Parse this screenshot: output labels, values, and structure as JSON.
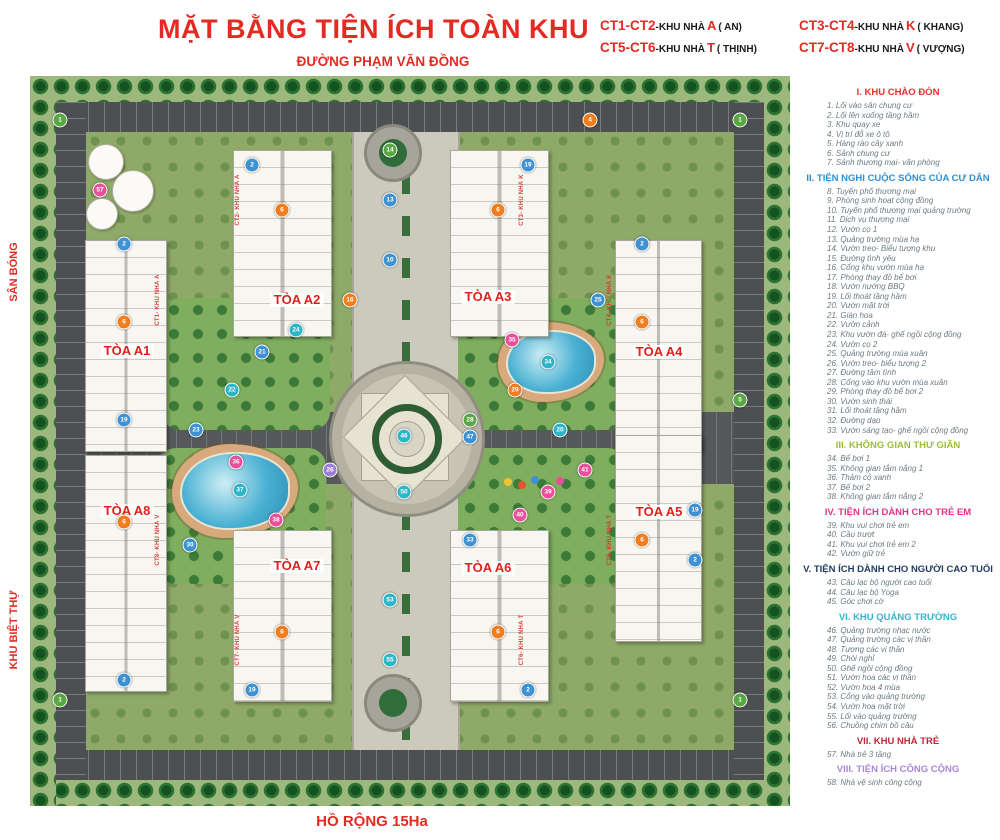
{
  "header": {
    "title": "MẶT BẰNG TIỆN ÍCH TOÀN KHU",
    "building_key": [
      {
        "code": "CT1-CT2",
        "sep": " - ",
        "label": "KHU NHÀ",
        "letter": "A",
        "suffix": "( AN)"
      },
      {
        "code": "CT3-CT4",
        "sep": " - ",
        "label": "KHU NHÀ",
        "letter": "K",
        "suffix": "( KHANG)"
      },
      {
        "code": "CT5-CT6",
        "sep": " - ",
        "label": "KHU NHÀ",
        "letter": "T",
        "suffix": "( THỊNH)"
      },
      {
        "code": "CT7-CT8",
        "sep": " - ",
        "label": "KHU NHÀ",
        "letter": "V",
        "suffix": "( VƯỢNG)"
      }
    ]
  },
  "map": {
    "road_top_label": "ĐƯỜNG PHẠM VĂN ĐỒNG",
    "edge_labels": {
      "left_top": "SÂN BÓNG",
      "left_bottom": "KHU BIỆT THỰ",
      "right": "BỘ CÔNG AN",
      "bottom": "HỒ RỘNG 15Ha"
    },
    "towers": [
      {
        "label": "TÒA A1",
        "x": 97,
        "y": 275
      },
      {
        "label": "TÒA A2",
        "x": 267,
        "y": 224
      },
      {
        "label": "TÒA A3",
        "x": 458,
        "y": 221
      },
      {
        "label": "TÒA A4",
        "x": 629,
        "y": 276
      },
      {
        "label": "TÒA A5",
        "x": 629,
        "y": 436
      },
      {
        "label": "TÒA A6",
        "x": 458,
        "y": 492
      },
      {
        "label": "TÒA A7",
        "x": 267,
        "y": 490
      },
      {
        "label": "TÒA A8",
        "x": 97,
        "y": 435
      }
    ],
    "building_tags": [
      {
        "text": "CT1- KHU NHÀ A",
        "x": 128,
        "y": 224
      },
      {
        "text": "CT2- KHU NHÀ A",
        "x": 208,
        "y": 124
      },
      {
        "text": "CT3- KHU NHÀ K",
        "x": 492,
        "y": 124
      },
      {
        "text": "CT4- KHU NHÀ K",
        "x": 580,
        "y": 224
      },
      {
        "text": "CT5- KHU NHÀ T",
        "x": 580,
        "y": 464
      },
      {
        "text": "CT6- KHU NHÀ T",
        "x": 492,
        "y": 564
      },
      {
        "text": "CT7- KHU NHÀ V",
        "x": 208,
        "y": 564
      },
      {
        "text": "CT8- KHU NHÀ V",
        "x": 128,
        "y": 464
      }
    ],
    "markers": [
      {
        "n": "2",
        "x": 94,
        "y": 168,
        "color": "#3f92d2"
      },
      {
        "n": "6",
        "x": 94,
        "y": 246,
        "color": "#f07d1e"
      },
      {
        "n": "19",
        "x": 94,
        "y": 344,
        "color": "#3f92d2"
      },
      {
        "n": "2",
        "x": 222,
        "y": 89,
        "color": "#3f92d2"
      },
      {
        "n": "6",
        "x": 252,
        "y": 134,
        "color": "#f07d1e"
      },
      {
        "n": "19",
        "x": 498,
        "y": 89,
        "color": "#3f92d2"
      },
      {
        "n": "6",
        "x": 468,
        "y": 134,
        "color": "#f07d1e"
      },
      {
        "n": "2",
        "x": 612,
        "y": 168,
        "color": "#3f92d2"
      },
      {
        "n": "6",
        "x": 612,
        "y": 246,
        "color": "#f07d1e"
      },
      {
        "n": "6",
        "x": 612,
        "y": 464,
        "color": "#f07d1e"
      },
      {
        "n": "19",
        "x": 665,
        "y": 434,
        "color": "#3f92d2"
      },
      {
        "n": "2",
        "x": 665,
        "y": 484,
        "color": "#3f92d2"
      },
      {
        "n": "6",
        "x": 468,
        "y": 556,
        "color": "#f07d1e"
      },
      {
        "n": "2",
        "x": 498,
        "y": 614,
        "color": "#3f92d2"
      },
      {
        "n": "6",
        "x": 252,
        "y": 556,
        "color": "#f07d1e"
      },
      {
        "n": "19",
        "x": 222,
        "y": 614,
        "color": "#3f92d2"
      },
      {
        "n": "6",
        "x": 94,
        "y": 446,
        "color": "#f07d1e"
      },
      {
        "n": "2",
        "x": 94,
        "y": 604,
        "color": "#3f92d2"
      },
      {
        "n": "21",
        "x": 232,
        "y": 276,
        "color": "#3f92d2"
      },
      {
        "n": "22",
        "x": 202,
        "y": 314,
        "color": "#2fb5c8"
      },
      {
        "n": "23",
        "x": 166,
        "y": 354,
        "color": "#3f92d2"
      },
      {
        "n": "24",
        "x": 266,
        "y": 254,
        "color": "#2fb5c8"
      },
      {
        "n": "34",
        "x": 518,
        "y": 286,
        "color": "#2fb5c8"
      },
      {
        "n": "35",
        "x": 482,
        "y": 264,
        "color": "#ea4f9b"
      },
      {
        "n": "25",
        "x": 568,
        "y": 224,
        "color": "#3f92d2"
      },
      {
        "n": "28",
        "x": 440,
        "y": 344,
        "color": "#58a644"
      },
      {
        "n": "37",
        "x": 210,
        "y": 414,
        "color": "#2fb5c8"
      },
      {
        "n": "38",
        "x": 246,
        "y": 444,
        "color": "#ea4f9b"
      },
      {
        "n": "30",
        "x": 160,
        "y": 469,
        "color": "#3f92d2"
      },
      {
        "n": "26",
        "x": 300,
        "y": 394,
        "color": "#9b7fd4"
      },
      {
        "n": "39",
        "x": 518,
        "y": 416,
        "color": "#ea4f9b"
      },
      {
        "n": "40",
        "x": 490,
        "y": 439,
        "color": "#ea4f9b"
      },
      {
        "n": "41",
        "x": 555,
        "y": 394,
        "color": "#ea4f9b"
      },
      {
        "n": "33",
        "x": 440,
        "y": 464,
        "color": "#3f92d2"
      },
      {
        "n": "46",
        "x": 374,
        "y": 360,
        "color": "#2fb5c8"
      },
      {
        "n": "50",
        "x": 374,
        "y": 416,
        "color": "#2fb5c8"
      },
      {
        "n": "47",
        "x": 440,
        "y": 361,
        "color": "#3f92d2"
      },
      {
        "n": "13",
        "x": 360,
        "y": 124,
        "color": "#3f92d2"
      },
      {
        "n": "10",
        "x": 360,
        "y": 184,
        "color": "#3f92d2"
      },
      {
        "n": "53",
        "x": 360,
        "y": 524,
        "color": "#2fb5c8"
      },
      {
        "n": "55",
        "x": 360,
        "y": 584,
        "color": "#2fb5c8"
      },
      {
        "n": "14",
        "x": 360,
        "y": 74,
        "color": "#58a644"
      },
      {
        "n": "1",
        "x": 30,
        "y": 44,
        "color": "#58a644"
      },
      {
        "n": "1",
        "x": 710,
        "y": 44,
        "color": "#58a644"
      },
      {
        "n": "1",
        "x": 30,
        "y": 624,
        "color": "#58a644"
      },
      {
        "n": "1",
        "x": 710,
        "y": 624,
        "color": "#58a644"
      },
      {
        "n": "57",
        "x": 70,
        "y": 114,
        "color": "#ea4f9b"
      },
      {
        "n": "4",
        "x": 560,
        "y": 44,
        "color": "#f07d1e"
      },
      {
        "n": "5",
        "x": 710,
        "y": 324,
        "color": "#58a644"
      },
      {
        "n": "16",
        "x": 320,
        "y": 224,
        "color": "#f07d1e"
      },
      {
        "n": "29",
        "x": 485,
        "y": 314,
        "color": "#f07d1e"
      },
      {
        "n": "36",
        "x": 206,
        "y": 386,
        "color": "#ea4f9b"
      },
      {
        "n": "20",
        "x": 530,
        "y": 354,
        "color": "#2fb5c8"
      }
    ]
  },
  "legend": {
    "sections": [
      {
        "header": "I. KHU CHÀO ĐÓN",
        "color": "#e53228",
        "items": [
          "1. Lối vào sân chung cư",
          "2. Lối lên xuống tầng hầm",
          "3. Khu quay xe",
          "4. Vị trí đỗ xe ô tô",
          "5. Hàng rào cây xanh",
          "6. Sảnh chung cư",
          "7. Sảnh thương mại- văn phòng"
        ]
      },
      {
        "header": "II. TIỆN NGHI CUỘC SỐNG CỦA CƯ DÂN",
        "color": "#2d8fd5",
        "items": [
          "8. Tuyến phố thương mại",
          "9. Phòng sinh hoạt cộng đồng",
          "10. Tuyến phố thương mại quảng trường",
          "11. Dịch vụ thương mại",
          "12. Vườn cọ 1",
          "13. Quảng trường mùa hạ",
          "14. Vườn treo- Biểu tượng khu",
          "15. Đường tình yêu",
          "16. Cổng khu vườn mùa hạ",
          "17. Phòng thay đồ bể bơi",
          "18. Vườn nướng BBQ",
          "19. Lối thoát tầng hầm",
          "20. Vườn mặt trời",
          "21. Giàn hoa",
          "22. Vườn cảnh",
          "23. Khu vườn đá- ghế ngồi cộng đồng",
          "24. Vườn cọ 2",
          "25. Quảng trường mùa xuân",
          "26. Vườn treo- biểu tượng 2",
          "27. Đường tâm tình",
          "28. Cổng vào khu vườn mùa xuân",
          "29. Phòng thay đồ bể bơi 2",
          "30. Vườn sinh thái",
          "31. Lối thoát tầng hầm",
          "32. Đường dạo",
          "33. Vườn sáng tạo- ghế ngồi cộng đồng"
        ]
      },
      {
        "header": "III. KHÔNG GIAN THƯ GIÃN",
        "color": "#9dc02e",
        "items": [
          "34. Bể bơi 1",
          "35. Không gian tắm nắng 1",
          "36. Thảm cỏ xanh",
          "37. Bể bơi 2",
          "38. Không gian tắm nắng 2"
        ]
      },
      {
        "header": "IV. TIỆN ÍCH DÀNH CHO TRẺ EM",
        "color": "#e8318a",
        "items": [
          "39. Khu vui chơi trẻ em",
          "40. Cầu trượt",
          "41. Khu vui chơi trẻ em 2",
          "42. Vườn giữ trẻ"
        ]
      },
      {
        "header": "V. TIỆN ÍCH DÀNH CHO NGƯỜI CAO TUỔI",
        "color": "#1e3a5f",
        "items": [
          "43. Câu lạc bộ người cao tuổi",
          "44. Câu lạc bộ Yoga",
          "45. Góc chơi cờ"
        ]
      },
      {
        "header": "VI. KHU QUẢNG TRƯỜNG",
        "color": "#35b4cf",
        "items": [
          "46. Quảng trường nhạc nước",
          "47. Quảng trường các vị thần",
          "48. Tượng các vị thần",
          "49. Chòi nghỉ",
          "50. Ghế ngồi cộng đồng",
          "51. Vườn hoa các vị thần",
          "52. Vườn hoa 4 mùa",
          "53. Cổng vào quảng trường",
          "54. Vườn hoa mặt trời",
          "55. Lối vào quảng trường",
          "56. Chuồng chim bồ câu"
        ]
      },
      {
        "header": "VII. KHU NHÀ TRẺ",
        "color": "#c02637",
        "items": [
          "57. Nhà trẻ 3 tầng"
        ]
      },
      {
        "header": "VIII. TIỆN ÍCH CÔNG CỘNG",
        "color": "#a985d8",
        "items": [
          "58. Nhà vệ sinh công cộng"
        ]
      }
    ]
  }
}
